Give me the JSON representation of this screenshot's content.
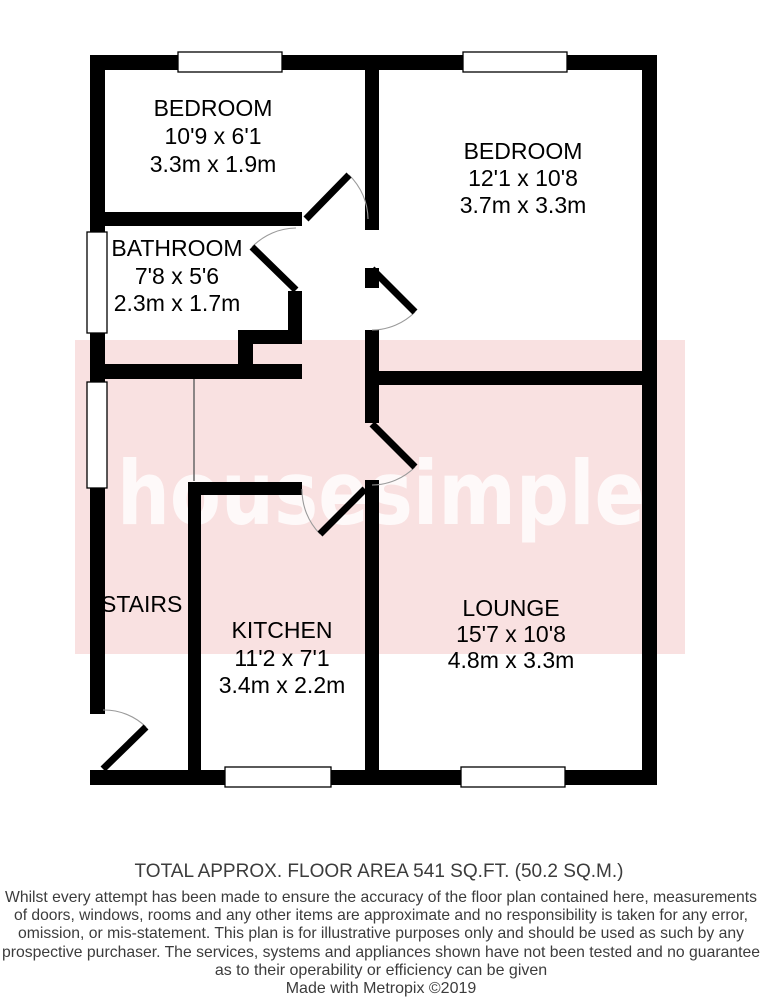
{
  "watermark": {
    "text": "housesimple",
    "band_color": "#f9e1e1",
    "text_color": "#ffffff"
  },
  "rooms": {
    "bedroom1": {
      "name": "BEDROOM",
      "dims_imperial": "10'9 x 6'1",
      "dims_metric": "3.3m x 1.9m"
    },
    "bedroom2": {
      "name": "BEDROOM",
      "dims_imperial": "12'1 x 10'8",
      "dims_metric": "3.7m x 3.3m"
    },
    "bathroom": {
      "name": "BATHROOM",
      "dims_imperial": "7'8 x 5'6",
      "dims_metric": "2.3m x 1.7m"
    },
    "kitchen": {
      "name": "KITCHEN",
      "dims_imperial": "11'2 x 7'1",
      "dims_metric": "3.4m x 2.2m"
    },
    "lounge": {
      "name": "LOUNGE",
      "dims_imperial": "15'7 x 10'8",
      "dims_metric": "4.8m x 3.3m"
    },
    "stairs": {
      "name": "STAIRS"
    }
  },
  "footer": {
    "total_area": "TOTAL APPROX. FLOOR AREA 541 SQ.FT. (50.2 SQ.M.)",
    "disclaimer_lines": [
      "Whilst every attempt has been made to ensure the accuracy of the floor plan contained here, measurements",
      "of doors, windows, rooms and any other items are approximate and no responsibility is taken for any error,",
      "omission, or mis-statement. This plan is for illustrative purposes only and should be used as such by any",
      "prospective purchaser. The services, systems and appliances shown have not been tested and no guarantee",
      "as to their operability or efficiency can be given"
    ],
    "credit": "Made with Metropix ©2019"
  }
}
